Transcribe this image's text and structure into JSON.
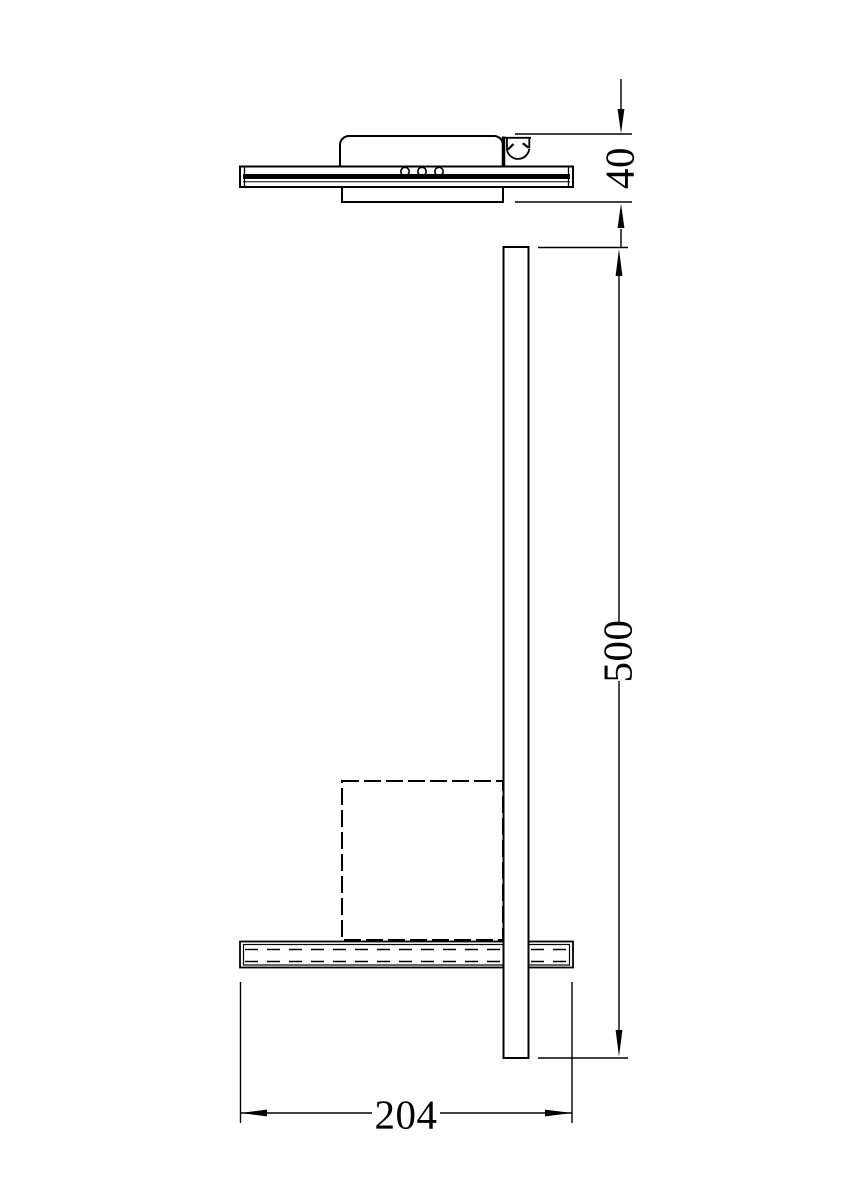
{
  "canvas": {
    "background": "#ffffff",
    "line_color": "#000000",
    "drawing_type": "dimensioned technical drawing (wall lamp side view)"
  },
  "dimensions": {
    "canopy_height": {
      "value": "40",
      "orientation": "vertical-rotated",
      "location": "top-right"
    },
    "arm_length": {
      "value": "500",
      "orientation": "vertical-rotated",
      "location": "right"
    },
    "plate_length": {
      "value": "204",
      "orientation": "horizontal",
      "location": "bottom"
    }
  }
}
